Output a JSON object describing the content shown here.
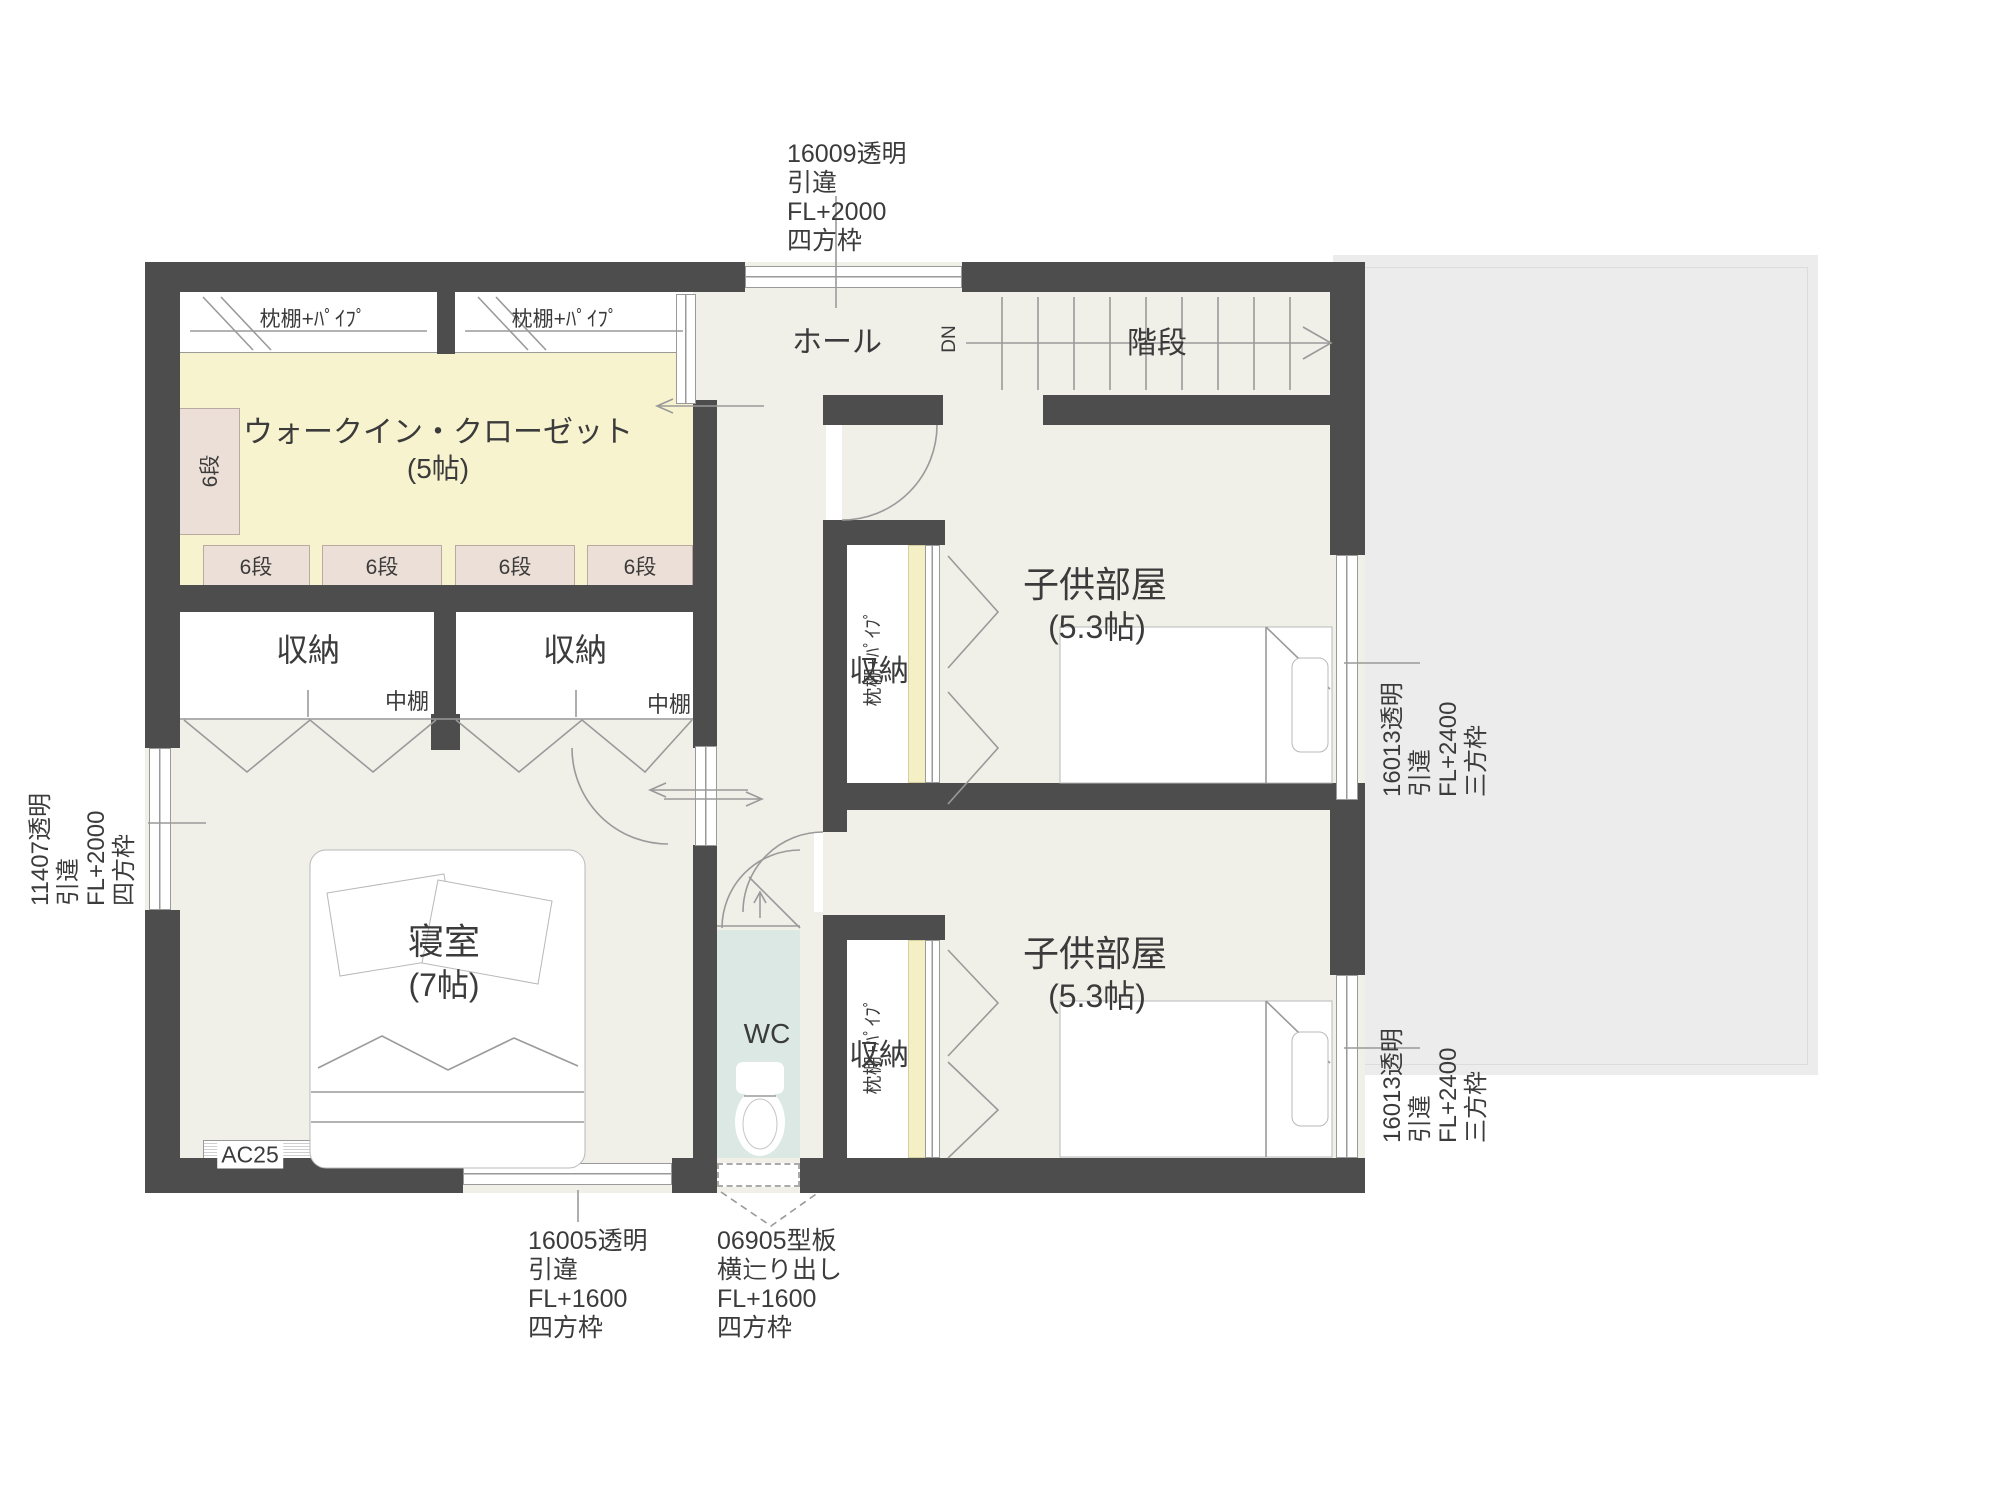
{
  "colors": {
    "wall": "#4d4d4d",
    "floor": "#f0efe8",
    "wic_floor": "#f8f3cf",
    "shelf_box": "#ecdfd7",
    "closet_shelf_strip": "#f5efc6",
    "wc_floor": "#dbe8e4",
    "roof_area": "#ececec"
  },
  "rooms": {
    "wic": {
      "name": "ウォークイン・クローゼット",
      "size": "(5帖)"
    },
    "hall": {
      "name": "ホール"
    },
    "stairs": {
      "name": "階段",
      "direction": "DN"
    },
    "child_room_1": {
      "name": "子供部屋",
      "size": "(5.3帖)"
    },
    "child_room_2": {
      "name": "子供部屋",
      "size": "(5.3帖)"
    },
    "bedroom": {
      "name": "寝室",
      "size": "(7帖)"
    },
    "wc": {
      "name": "WC"
    },
    "storage_1": {
      "name": "収納",
      "shelf": "中棚"
    },
    "storage_2": {
      "name": "収納",
      "shelf": "中棚"
    },
    "closet_1": {
      "name": "収納",
      "shelf": "枕棚+ﾊﾟｲﾌﾟ"
    },
    "closet_2": {
      "name": "収納",
      "shelf": "枕棚+ﾊﾟｲﾌﾟ"
    }
  },
  "shelves": {
    "wic_top_left": "枕棚+ﾊﾟｲﾌﾟ",
    "wic_top_right": "枕棚+ﾊﾟｲﾌﾟ",
    "wic_left_vertical": "6段",
    "row": [
      "6段",
      "6段",
      "6段",
      "6段"
    ]
  },
  "equipment": {
    "air_conditioner": "AC25"
  },
  "annotations": {
    "top_window": {
      "lines": [
        "16009透明",
        "引違",
        "FL+2000",
        "四方枠"
      ]
    },
    "left_window": {
      "lines": [
        "11407透明",
        "引違",
        "FL+2000",
        "四方枠"
      ]
    },
    "right_window_1": {
      "lines": [
        "16013透明",
        "引違",
        "FL+2400",
        "三方枠"
      ]
    },
    "right_window_2": {
      "lines": [
        "16013透明",
        "引違",
        "FL+2400",
        "三方枠"
      ]
    },
    "bottom_window_1": {
      "lines": [
        "16005透明",
        "引違",
        "FL+1600",
        "四方枠"
      ]
    },
    "bottom_window_2": {
      "lines": [
        "06905型板",
        "横辷り出し",
        "FL+1600",
        "四方枠"
      ]
    }
  }
}
